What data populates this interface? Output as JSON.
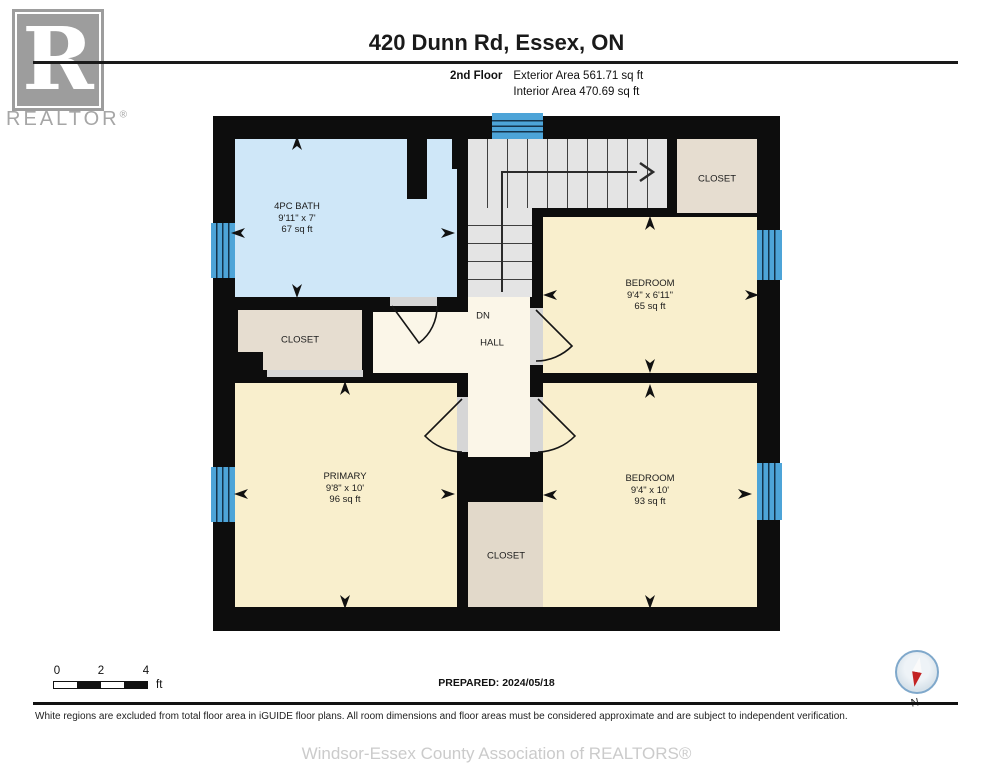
{
  "header": {
    "logo_letter": "R",
    "logo_brand": "REALTOR",
    "logo_reg": "®",
    "title": "420 Dunn Rd, Essex, ON",
    "floor_label": "2nd Floor",
    "exterior_area": "Exterior Area 561.71 sq ft",
    "interior_area": "Interior Area 470.69 sq ft"
  },
  "plan": {
    "rooms": {
      "bath": {
        "name": "4PC BATH",
        "dims": "9'11\" x 7'",
        "area": "67 sq ft"
      },
      "closet_top_right": {
        "name": "CLOSET"
      },
      "bedroom_top": {
        "name": "BEDROOM",
        "dims": "9'4\" x 6'11\"",
        "area": "65 sq ft"
      },
      "closet_left": {
        "name": "CLOSET"
      },
      "stairs_label": "DN",
      "hall": {
        "name": "HALL"
      },
      "primary": {
        "name": "PRIMARY",
        "dims": "9'8\" x 10'",
        "area": "96 sq ft"
      },
      "closet_center": {
        "name": "CLOSET"
      },
      "bedroom_bottom": {
        "name": "BEDROOM",
        "dims": "9'4\" x 10'",
        "area": "93 sq ft"
      }
    }
  },
  "colors": {
    "wall": "#0d0d0d",
    "bath": "#cfe7f8",
    "room": "#f9efcd",
    "hall": "#fbf6e8",
    "closet": "#e6ddd0",
    "closet-center": "#e2d9ca",
    "stairs": "#e4e4e4",
    "window": "#4da4d8"
  },
  "footer": {
    "scale_ticks": [
      "0",
      "2",
      "4"
    ],
    "scale_unit": "ft",
    "prepared": "PREPARED: 2024/05/18",
    "compass_label": "N",
    "disclaimer": "White regions are excluded from total floor area in iGUIDE floor plans. All room dimensions and floor areas must be considered approximate and are subject to independent verification.",
    "watermark": "Windsor-Essex County Association of REALTORS®"
  }
}
